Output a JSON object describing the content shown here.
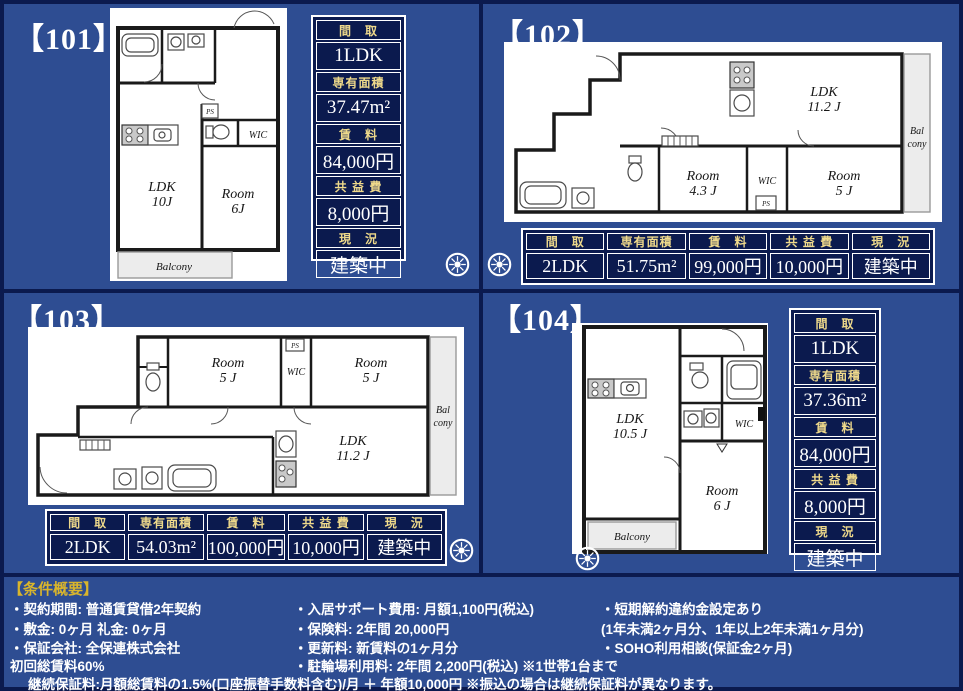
{
  "colors": {
    "background_blue": "#2e4d92",
    "panel_navy": "#0b1a4e",
    "header_gold": "#eed98b",
    "title_yellow": "#d9b52c",
    "text_white": "#ffffff"
  },
  "labels": {
    "layout": "間　取",
    "area": "専有面積",
    "rent": "賃　料",
    "fee": "共 益 費",
    "status": "現　況"
  },
  "units": [
    {
      "id": "101",
      "title": "【101】",
      "layout": "1LDK",
      "area": "37.47m²",
      "rent": "84,000円",
      "fee": "8,000円",
      "status": "建築中",
      "plan": {
        "ldk": "LDK",
        "ldk_size": "10J",
        "room": "Room",
        "room_size": "6J",
        "wic": "WIC",
        "ps": "PS",
        "balcony": "Balcony"
      }
    },
    {
      "id": "102",
      "title": "【102】",
      "layout": "2LDK",
      "area": "51.75m²",
      "rent": "99,000円",
      "fee": "10,000円",
      "status": "建築中",
      "plan": {
        "ldk": "LDK",
        "ldk_size": "11.2 J",
        "room1": "Room",
        "room1_size": "4.3 J",
        "room2": "Room",
        "room2_size": "5 J",
        "wic": "WIC",
        "ps": "PS",
        "balcony_line1": "Bal",
        "balcony_line2": "cony"
      }
    },
    {
      "id": "103",
      "title": "【103】",
      "layout": "2LDK",
      "area": "54.03m²",
      "rent": "100,000円",
      "fee": "10,000円",
      "status": "建築中",
      "plan": {
        "ldk": "LDK",
        "ldk_size": "11.2 J",
        "room1": "Room",
        "room1_size": "5 J",
        "room2": "Room",
        "room2_size": "5 J",
        "wic": "WIC",
        "ps": "PS",
        "balcony_line1": "Bal",
        "balcony_line2": "cony"
      }
    },
    {
      "id": "104",
      "title": "【104】",
      "layout": "1LDK",
      "area": "37.36m²",
      "rent": "84,000円",
      "fee": "8,000円",
      "status": "建築中",
      "plan": {
        "ldk": "LDK",
        "ldk_size": "10.5 J",
        "room": "Room",
        "room_size": "6 J",
        "wic": "WIC",
        "balcony": "Balcony"
      }
    }
  ],
  "conditions": {
    "title": "【条件概要】",
    "col1": [
      "・契約期間:  普通賃貸借2年契約",
      "・敷金:  0ヶ月  礼金:  0ヶ月",
      "・保証会社:  全保連株式会社",
      "  初回総賃料60%"
    ],
    "col2": [
      "・入居サポート費用:  月額1,100円(税込)",
      "・保険料:  2年間  20,000円",
      "・更新料:  新賃料の1ヶ月分",
      "・駐輪場利用料:  2年間  2,200円(税込)  ※1世帯1台まで"
    ],
    "col3": [
      "・短期解約違約金設定あり",
      "(1年未満2ヶ月分、1年以上2年未満1ヶ月分)",
      "・SOHO利用相談(保証金2ヶ月)"
    ],
    "footer": "継続保証料:月額総賃料の1.5%(口座振替手数料含む)/月  ＋  年額10,000円  ※振込の場合は継続保証料が異なります。"
  }
}
